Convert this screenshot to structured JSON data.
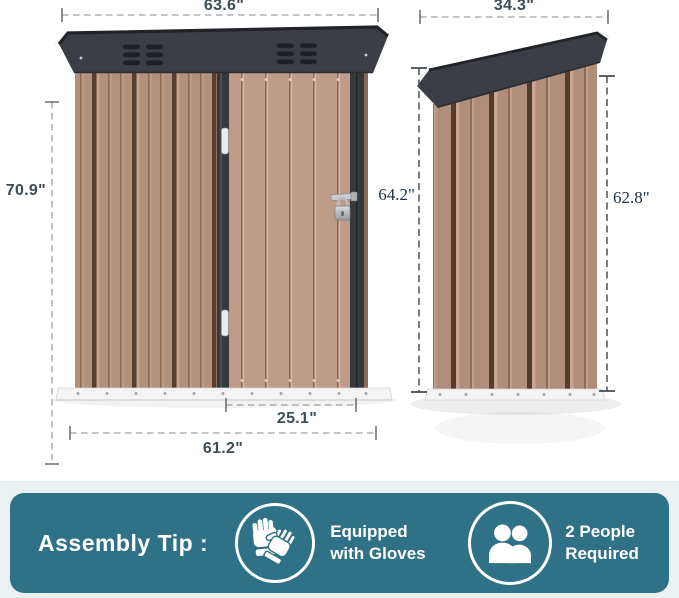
{
  "diagram": {
    "front_view": {
      "width_top": "63.6\"",
      "height": "70.9\"",
      "door_width": "25.1\"",
      "width_bottom": "61.2\""
    },
    "side_view": {
      "width_top": "34.3\"",
      "height_left": "64.2\"",
      "height_right": "62.8\""
    }
  },
  "banner": {
    "title": "Assembly Tip :",
    "tips": [
      {
        "icon": "gloves-icon",
        "label": "Equipped with Gloves"
      },
      {
        "icon": "people-icon",
        "label": "2 People Required"
      }
    ]
  },
  "colors": {
    "banner_teal": "#2f7186",
    "footer_strip": "#eaf1f3",
    "shed_wall_brown": "#b2907c",
    "shed_door_brown": "#bf9c8a",
    "roof_dark_gray": "#3b3e44",
    "dim_label_sans": "#3b4d55",
    "dim_label_serif": "#1d3147"
  }
}
